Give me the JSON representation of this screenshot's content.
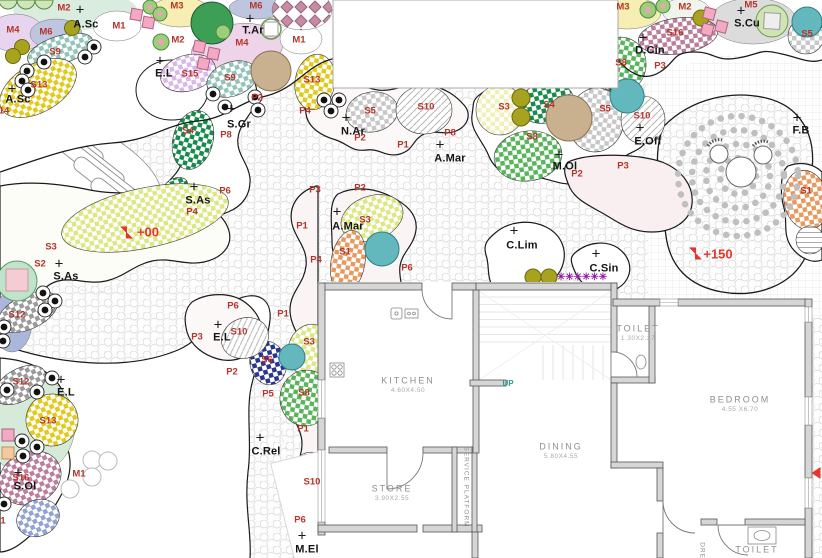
{
  "plan": {
    "type": "landscape-garden-plan-with-floor-plan",
    "colors": {
      "code_label": "#b5342c",
      "plant_marker": "#141414",
      "elevation": "#e8352a",
      "asterisk": "#8d1f9e",
      "up": "#2a9a8f",
      "room_label": "#8f8f8f",
      "checker_teal": "#93c4b9",
      "checker_yellow": "#e2ca1d",
      "checker_lilac": "#d9b6ec",
      "checker_darkgreen": "#168c4c",
      "checker_green": "#58b55a",
      "checker_lime": "#dce884",
      "checker_paleyellow": "#f2f0b8",
      "checker_gray": "#c8c8c8",
      "checker_darkgray": "#9b9b9b",
      "checker_orange": "#e9995d",
      "checker_mauve": "#ba7f9d",
      "checker_navy": "#2b3590",
      "checker_blue": "#93a4d3",
      "pastel_lavender": "#e7d4ef",
      "pastel_bluegray": "#bdc5df",
      "pastel_yellow": "#f6eeb2",
      "pastel_pink": "#eed4e8",
      "pastel_teal": "#d9ecdf",
      "pastel_graybed": "#dcdcdc",
      "olive": "#a8a31e",
      "teal_tree": "#62b8bc",
      "tan_tree": "#c9b18f",
      "green_tree": "#3d9e55",
      "mint": "#d5ead8"
    }
  },
  "plant_markers": [
    {
      "label": "A.Sc",
      "tx": 86,
      "ty": 25,
      "cx": 80,
      "cy": 10
    },
    {
      "label": "A.Sc",
      "tx": 18,
      "ty": 100,
      "cx": 12,
      "cy": 89
    },
    {
      "label": "T.Ar",
      "tx": 253,
      "ty": 31,
      "cx": 250,
      "cy": 19
    },
    {
      "label": "E.L",
      "tx": 164,
      "ty": 74,
      "cx": 160,
      "cy": 61
    },
    {
      "label": "S.Gr",
      "tx": 239,
      "ty": 125,
      "cx": 231,
      "cy": 109
    },
    {
      "label": "S.As",
      "tx": 198,
      "ty": 201,
      "cx": 194,
      "cy": 187
    },
    {
      "label": "S.As",
      "tx": 66,
      "ty": 277,
      "cx": 59,
      "cy": 264
    },
    {
      "label": "N.Ar",
      "tx": 353,
      "ty": 132,
      "cx": 346,
      "cy": 118
    },
    {
      "label": "A.Mar",
      "tx": 450,
      "ty": 159,
      "cx": 440,
      "cy": 145
    },
    {
      "label": "A.Mar",
      "tx": 348,
      "ty": 227,
      "cx": 337,
      "cy": 212
    },
    {
      "label": "M.Ol",
      "tx": 565,
      "ty": 167,
      "cx": 559,
      "cy": 155
    },
    {
      "label": "E.Off",
      "tx": 648,
      "ty": 142,
      "cx": 640,
      "cy": 128
    },
    {
      "label": "S.Cu",
      "tx": 747,
      "ty": 24,
      "cx": 741,
      "cy": 11
    },
    {
      "label": "D.Cin",
      "tx": 650,
      "ty": 51,
      "cx": 643,
      "cy": 38
    },
    {
      "label": "F.B",
      "tx": 801,
      "ty": 131,
      "cx": 797,
      "cy": 118
    },
    {
      "label": "C.Lim",
      "tx": 522,
      "ty": 246,
      "cx": 514,
      "cy": 231
    },
    {
      "label": "C.Sin",
      "tx": 604,
      "ty": 269,
      "cx": 596,
      "cy": 254
    },
    {
      "label": "C.Rel",
      "tx": 266,
      "ty": 452,
      "cx": 260,
      "cy": 438
    },
    {
      "label": "S.Ol",
      "tx": 25,
      "ty": 487,
      "cx": 18,
      "cy": 473
    },
    {
      "label": "E.L",
      "tx": 222,
      "ty": 338,
      "cx": 218,
      "cy": 325
    },
    {
      "label": "E.L",
      "tx": 66,
      "ty": 393,
      "cx": 61,
      "cy": 380
    },
    {
      "label": "M.El",
      "tx": 307,
      "ty": 550,
      "cx": 302,
      "cy": 536
    }
  ],
  "code_labels": [
    {
      "label": "M2",
      "x": 64,
      "y": 8
    },
    {
      "label": "M4",
      "x": 13,
      "y": 30
    },
    {
      "label": "M6",
      "x": 46,
      "y": 32
    },
    {
      "label": "M1",
      "x": 119,
      "y": 26
    },
    {
      "label": "M3",
      "x": 177,
      "y": 6
    },
    {
      "label": "M6",
      "x": 256,
      "y": 6
    },
    {
      "label": "M2",
      "x": 178,
      "y": 40
    },
    {
      "label": "M4",
      "x": 242,
      "y": 43
    },
    {
      "label": "M1",
      "x": 299,
      "y": 40
    },
    {
      "label": "M3",
      "x": 623,
      "y": 7
    },
    {
      "label": "M2",
      "x": 685,
      "y": 7
    },
    {
      "label": "M5",
      "x": 751,
      "y": 5
    },
    {
      "label": "S16",
      "x": 675,
      "y": 33
    },
    {
      "label": "S8",
      "x": 621,
      "y": 63
    },
    {
      "label": "P3",
      "x": 660,
      "y": 66
    },
    {
      "label": "S5",
      "x": 807,
      "y": 34
    },
    {
      "label": "S9",
      "x": 55,
      "y": 52
    },
    {
      "label": "S13",
      "x": 39,
      "y": 85
    },
    {
      "label": "14",
      "x": 4,
      "y": 111
    },
    {
      "label": "S15",
      "x": 190,
      "y": 74
    },
    {
      "label": "S9",
      "x": 230,
      "y": 78
    },
    {
      "label": "S13",
      "x": 312,
      "y": 80
    },
    {
      "label": "P2",
      "x": 257,
      "y": 98
    },
    {
      "label": "P4",
      "x": 305,
      "y": 111
    },
    {
      "label": "S4",
      "x": 188,
      "y": 131
    },
    {
      "label": "P8",
      "x": 226,
      "y": 135
    },
    {
      "label": "P6",
      "x": 225,
      "y": 191
    },
    {
      "label": "P4",
      "x": 192,
      "y": 212
    },
    {
      "label": "S5",
      "x": 370,
      "y": 111
    },
    {
      "label": "S10",
      "x": 426,
      "y": 107
    },
    {
      "label": "P2",
      "x": 360,
      "y": 138
    },
    {
      "label": "P1",
      "x": 403,
      "y": 145
    },
    {
      "label": "P8",
      "x": 450,
      "y": 133
    },
    {
      "label": "S3",
      "x": 504,
      "y": 107
    },
    {
      "label": "S4",
      "x": 549,
      "y": 105
    },
    {
      "label": "S8",
      "x": 532,
      "y": 137
    },
    {
      "label": "S5",
      "x": 605,
      "y": 109
    },
    {
      "label": "S10",
      "x": 642,
      "y": 116
    },
    {
      "label": "P2",
      "x": 577,
      "y": 174
    },
    {
      "label": "P3",
      "x": 623,
      "y": 166
    },
    {
      "label": "S1",
      "x": 806,
      "y": 191
    },
    {
      "label": "S3",
      "x": 51,
      "y": 247
    },
    {
      "label": "S2",
      "x": 40,
      "y": 264
    },
    {
      "label": "S12",
      "x": 17,
      "y": 315
    },
    {
      "label": "S3",
      "x": 365,
      "y": 220
    },
    {
      "label": "S1",
      "x": 345,
      "y": 252
    },
    {
      "label": "P6",
      "x": 407,
      "y": 268
    },
    {
      "label": "P3",
      "x": 315,
      "y": 190
    },
    {
      "label": "P2",
      "x": 360,
      "y": 188
    },
    {
      "label": "P1",
      "x": 302,
      "y": 226
    },
    {
      "label": "P4",
      "x": 316,
      "y": 260
    },
    {
      "label": "P1",
      "x": 283,
      "y": 314
    },
    {
      "label": "S3",
      "x": 309,
      "y": 342
    },
    {
      "label": "S6",
      "x": 267,
      "y": 360
    },
    {
      "label": "P6",
      "x": 233,
      "y": 306
    },
    {
      "label": "P3",
      "x": 197,
      "y": 337
    },
    {
      "label": "S10",
      "x": 239,
      "y": 332
    },
    {
      "label": "P2",
      "x": 232,
      "y": 372
    },
    {
      "label": "P5",
      "x": 268,
      "y": 394
    },
    {
      "label": "S8",
      "x": 304,
      "y": 393
    },
    {
      "label": "P1",
      "x": 303,
      "y": 429
    },
    {
      "label": "S10",
      "x": 312,
      "y": 482
    },
    {
      "label": "P6",
      "x": 300,
      "y": 520
    },
    {
      "label": "S12",
      "x": 21,
      "y": 382
    },
    {
      "label": "S13",
      "x": 48,
      "y": 421
    },
    {
      "label": "S16",
      "x": 21,
      "y": 478
    },
    {
      "label": "M1",
      "x": 79,
      "y": 474
    },
    {
      "label": "1",
      "x": 3,
      "y": 521
    }
  ],
  "elevation_markers": [
    {
      "label": "+00",
      "x": 148,
      "y": 232,
      "ix": 127,
      "iy": 233
    },
    {
      "label": "+150",
      "x": 718,
      "y": 254,
      "ix": 696,
      "iy": 254
    }
  ],
  "rooms": [
    {
      "name": "KITCHEN",
      "dim": "4.60X4.50",
      "x": 408,
      "y": 381
    },
    {
      "name": "STORE",
      "dim": "3.90X2.55",
      "x": 392,
      "y": 489
    },
    {
      "name": "DINING",
      "dim": "5.80X4.55",
      "x": 561,
      "y": 447
    },
    {
      "name": "BEDROOM",
      "dim": "4.55 X6.70",
      "x": 740,
      "y": 400
    },
    {
      "name": "TOILET",
      "dim": "1.30X2.27",
      "x": 638,
      "y": 329
    },
    {
      "name": "TOILET",
      "dim": "",
      "x": 757,
      "y": 550
    }
  ],
  "annotations": {
    "up_label": "UP",
    "up_x": 508,
    "up_y": 384,
    "service_platform_label": "SERVICE PLATFORM",
    "sp_x": 465,
    "sp_y": 487,
    "dress_label": "DRESS",
    "dress_x": 701,
    "dress_y": 556,
    "asterisk_row": "✳✳✳✳✳✳",
    "ast_x": 582,
    "ast_y": 278,
    "edge_marker_x": 816,
    "edge_marker_y": 473
  }
}
